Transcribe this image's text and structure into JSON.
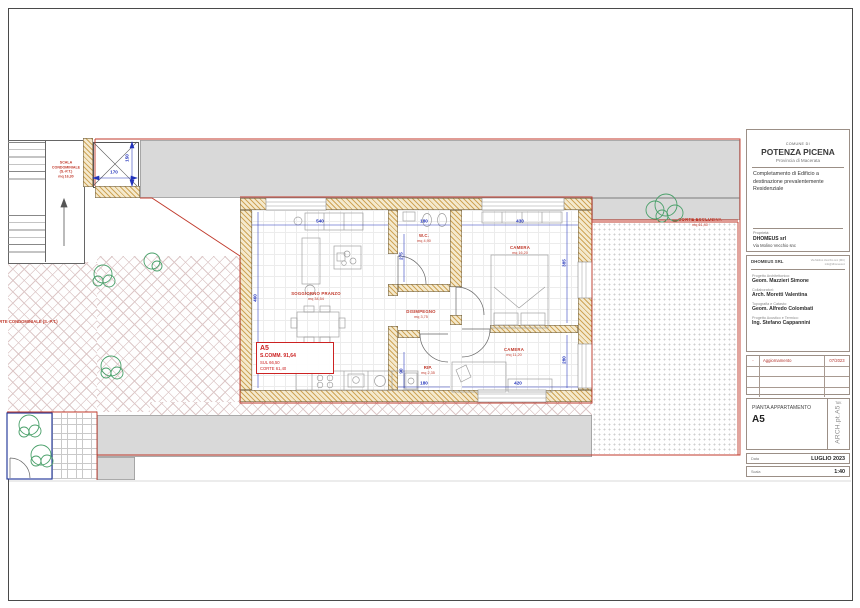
{
  "plan": {
    "rooms": {
      "soggiorno": {
        "name": "SOGGIORNO PRANZO",
        "area": "mq 34,54"
      },
      "wc": {
        "name": "W.C.",
        "area": "mq 4,90"
      },
      "disimpegno": {
        "name": "DISIMPEGNO",
        "area": "mq 3,75"
      },
      "rip": {
        "name": "RIP.",
        "area": "mq 2,35"
      },
      "camera1": {
        "name": "CAMERA",
        "area": "mq 16,20"
      },
      "camera2": {
        "name": "CAMERA",
        "area": "mq 11,20"
      }
    },
    "outdoor": {
      "corte_esclusiva_name": "CORTE ESCLUSIVA",
      "corte_esclusiva_area": "mq 61,40",
      "corte_condominiale": "CORTE CONDOMINIALE (S.-P.T.)",
      "scala": "SCALA\nCONDOMINIALE\n(S.-P.T.)\nmq 16,30"
    },
    "info_box": {
      "code": "A5",
      "comm": "S.COMM. 91,64",
      "sul": "SUL 66,50",
      "corte": "CORTE 61,40"
    },
    "dims": {
      "lift_w": "170",
      "lift_h": "150",
      "sogg_w": "540",
      "wc_w": "180",
      "cam1_w": "430",
      "sogg_h": "460",
      "wc_h": "275",
      "rip_h": "90",
      "rip_w": "180",
      "cam2_w": "420",
      "cam1_h": "385",
      "cam2_h": "280"
    }
  },
  "title_block": {
    "comune_small": "COMUNE DI",
    "comune": "POTENZA PICENA",
    "provincia": "Provincia di Macerata",
    "description": "Completamento di Edificio a destinazione prevalentemente Residenziale",
    "owner_label": "Proprietà:",
    "owner_name": "DHOMEUS srl",
    "owner_address": "Via Molino Vecchio snc",
    "firm_name": "DHOMEUS SRL",
    "firm_info1": "Via Molino Vecchio snc (MC)",
    "firm_info2": "info@dhomeus.it",
    "sections": [
      {
        "label": "Progetto Architettonico:",
        "name": "Geom. Mazzieri Simone"
      },
      {
        "label": "Collaboratori:",
        "name": "Arch. Moretti Valentina"
      },
      {
        "label": "Topografia e Catasto:",
        "name": "Geom. Alfredo Colombati"
      },
      {
        "label": "Progetto Acustico e Termico:",
        "name": "Ing. Stefano Cappannini"
      }
    ],
    "revision": {
      "mark": "-",
      "label": "Aggiornamento",
      "date": "07/2023"
    },
    "drawing": {
      "title": "PIANTA APPARTAMENTO",
      "code": "A5",
      "tav": "TAV.",
      "file_code": "ARCH.pt.A5"
    },
    "footer": {
      "date_label": "Data",
      "date_value": "LUGLIO 2023",
      "scale_label": "Scala",
      "scale_value": "1:40"
    }
  },
  "colors": {
    "boundary_red": "#c0392b",
    "dimension_blue": "#2233bb",
    "label_red": "#cc2222",
    "plant_green": "#4aa06a",
    "area_gray": "#d9d9d9"
  }
}
